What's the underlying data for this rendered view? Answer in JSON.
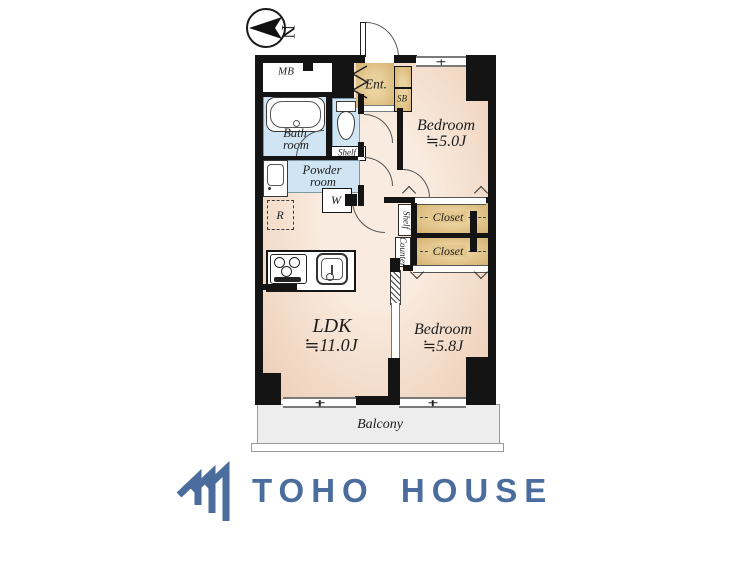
{
  "compass": {
    "north_label": "N"
  },
  "plan": {
    "mb": "MB",
    "bath": {
      "line1": "Bath",
      "line2": "room"
    },
    "toilet_shelf": "Shelf",
    "powder": {
      "line1": "Powder",
      "line2": "room"
    },
    "washer": "W",
    "fridge": "R",
    "entrance": "Ent.",
    "shoebox": "SB",
    "bedroom1": {
      "name": "Bedroom",
      "size": "≒5.0J"
    },
    "bedroom2": {
      "name": "Bedroom",
      "size": "≒5.8J"
    },
    "ldk": {
      "name": "LDK",
      "size": "≒11.0J"
    },
    "closet1": "Closet",
    "closet2": "Closet",
    "shelf_vertical": "Shelf",
    "counter_vertical": "Counter",
    "balcony": "Balcony"
  },
  "branding": {
    "logo_text": "TOHO HOUSE"
  },
  "colors": {
    "wall": "#141414",
    "floor_warm": "#f2d7c2",
    "wet_blue": "#cfe5f3",
    "storage_tan": "#dcbe82",
    "balcony_gray": "#ededed",
    "logo_blue": "#4a6d9e"
  }
}
